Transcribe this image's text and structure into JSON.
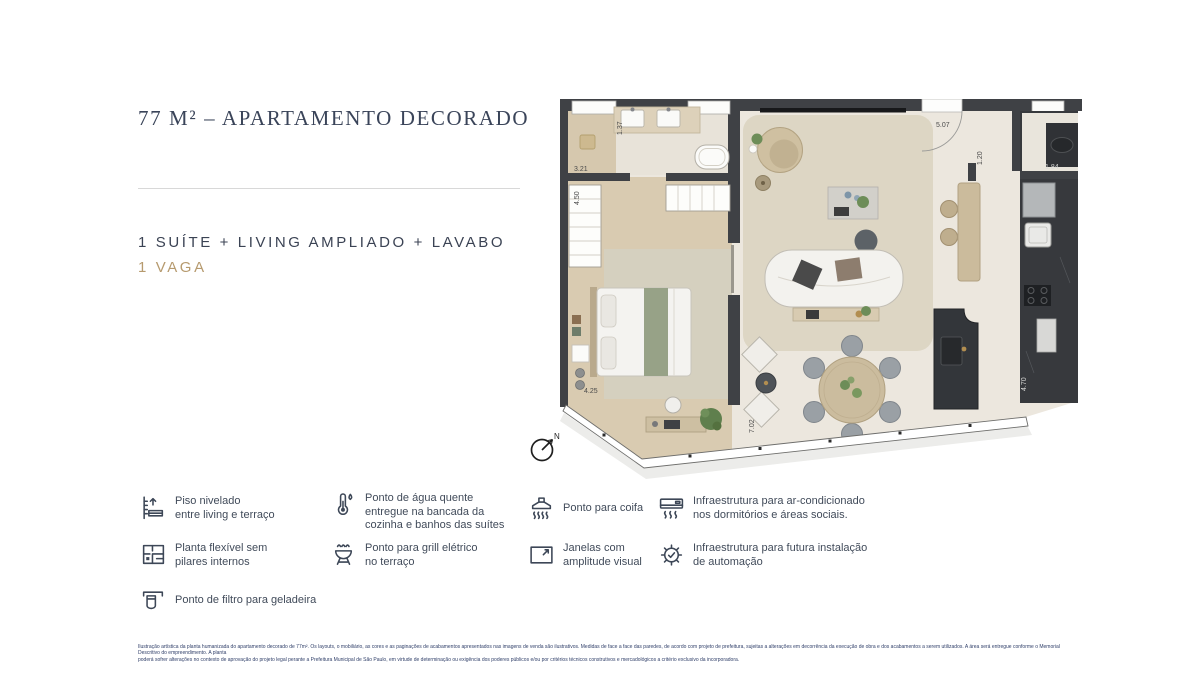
{
  "header": {
    "title": "77 M² – APARTAMENTO DECORADO",
    "subtitle": "1 SUÍTE + LIVING AMPLIADO + LAVABO",
    "parking": "1 VAGA"
  },
  "colors": {
    "navy": "#3a4459",
    "tan": "#b69a6e",
    "wall": "#3f4145",
    "wood_floor": "#d9cbb1",
    "living_rug": "#ddd6c4",
    "legend_text": "#414b5a"
  },
  "floorplan": {
    "compass_label": "N",
    "dims": {
      "vanity": "1.37",
      "bath_closet": "3.21",
      "wardrobe": "4.50",
      "bedroom": "4.25",
      "living_width": "5.07",
      "hall": "1.20",
      "lavabo": "1.84",
      "kitchen": "4.70",
      "living_depth": "7.02"
    }
  },
  "legend": {
    "items": [
      {
        "icon": "floor-level-icon",
        "label": "Piso nivelado\nentre living e terraço"
      },
      {
        "icon": "hot-water-icon",
        "label": "Ponto de água quente\nentregue na bancada da\ncozinha e banhos das suítes"
      },
      {
        "icon": "range-hood-icon",
        "label": "Ponto para coifa"
      },
      {
        "icon": "air-conditioning-icon",
        "label": "Infraestrutura para ar-condicionado\nnos dormitórios e áreas sociais."
      },
      {
        "icon": "flexible-plan-icon",
        "label": "Planta flexível sem\npilares internos"
      },
      {
        "icon": "electric-grill-icon",
        "label": "Ponto para grill elétrico\nno terraço"
      },
      {
        "icon": "window-icon",
        "label": "Janelas com\namplitude visual"
      },
      {
        "icon": "automation-icon",
        "label": "Infraestrutura para futura instalação\nde automação"
      },
      {
        "icon": "fridge-filter-icon",
        "label": "Ponto de filtro para geladeira"
      }
    ]
  },
  "disclaimer": {
    "line1": "Ilustração artística da planta humanizada do apartamento decorado de 77m². Os layouts, o mobiliário, as cores e as paginações de acabamentos apresentados nas imagens de venda são ilustrativos. Medidas de face a face das paredes, de acordo com projeto de prefeitura, sujeitas a alterações em decorrência da execução de obra e dos acabamentos a serem utilizados. A área será entregue conforme o Memorial Descritivo do empreendimento. A planta",
    "line2": "poderá sofrer alterações no contexto de aprovação do projeto legal perante a Prefeitura Municipal de São Paulo, em virtude de determinação ou exigência dos poderes públicos e/ou por critérios técnicos construtivos e mercadológicos a critério exclusivo da incorporadora."
  }
}
